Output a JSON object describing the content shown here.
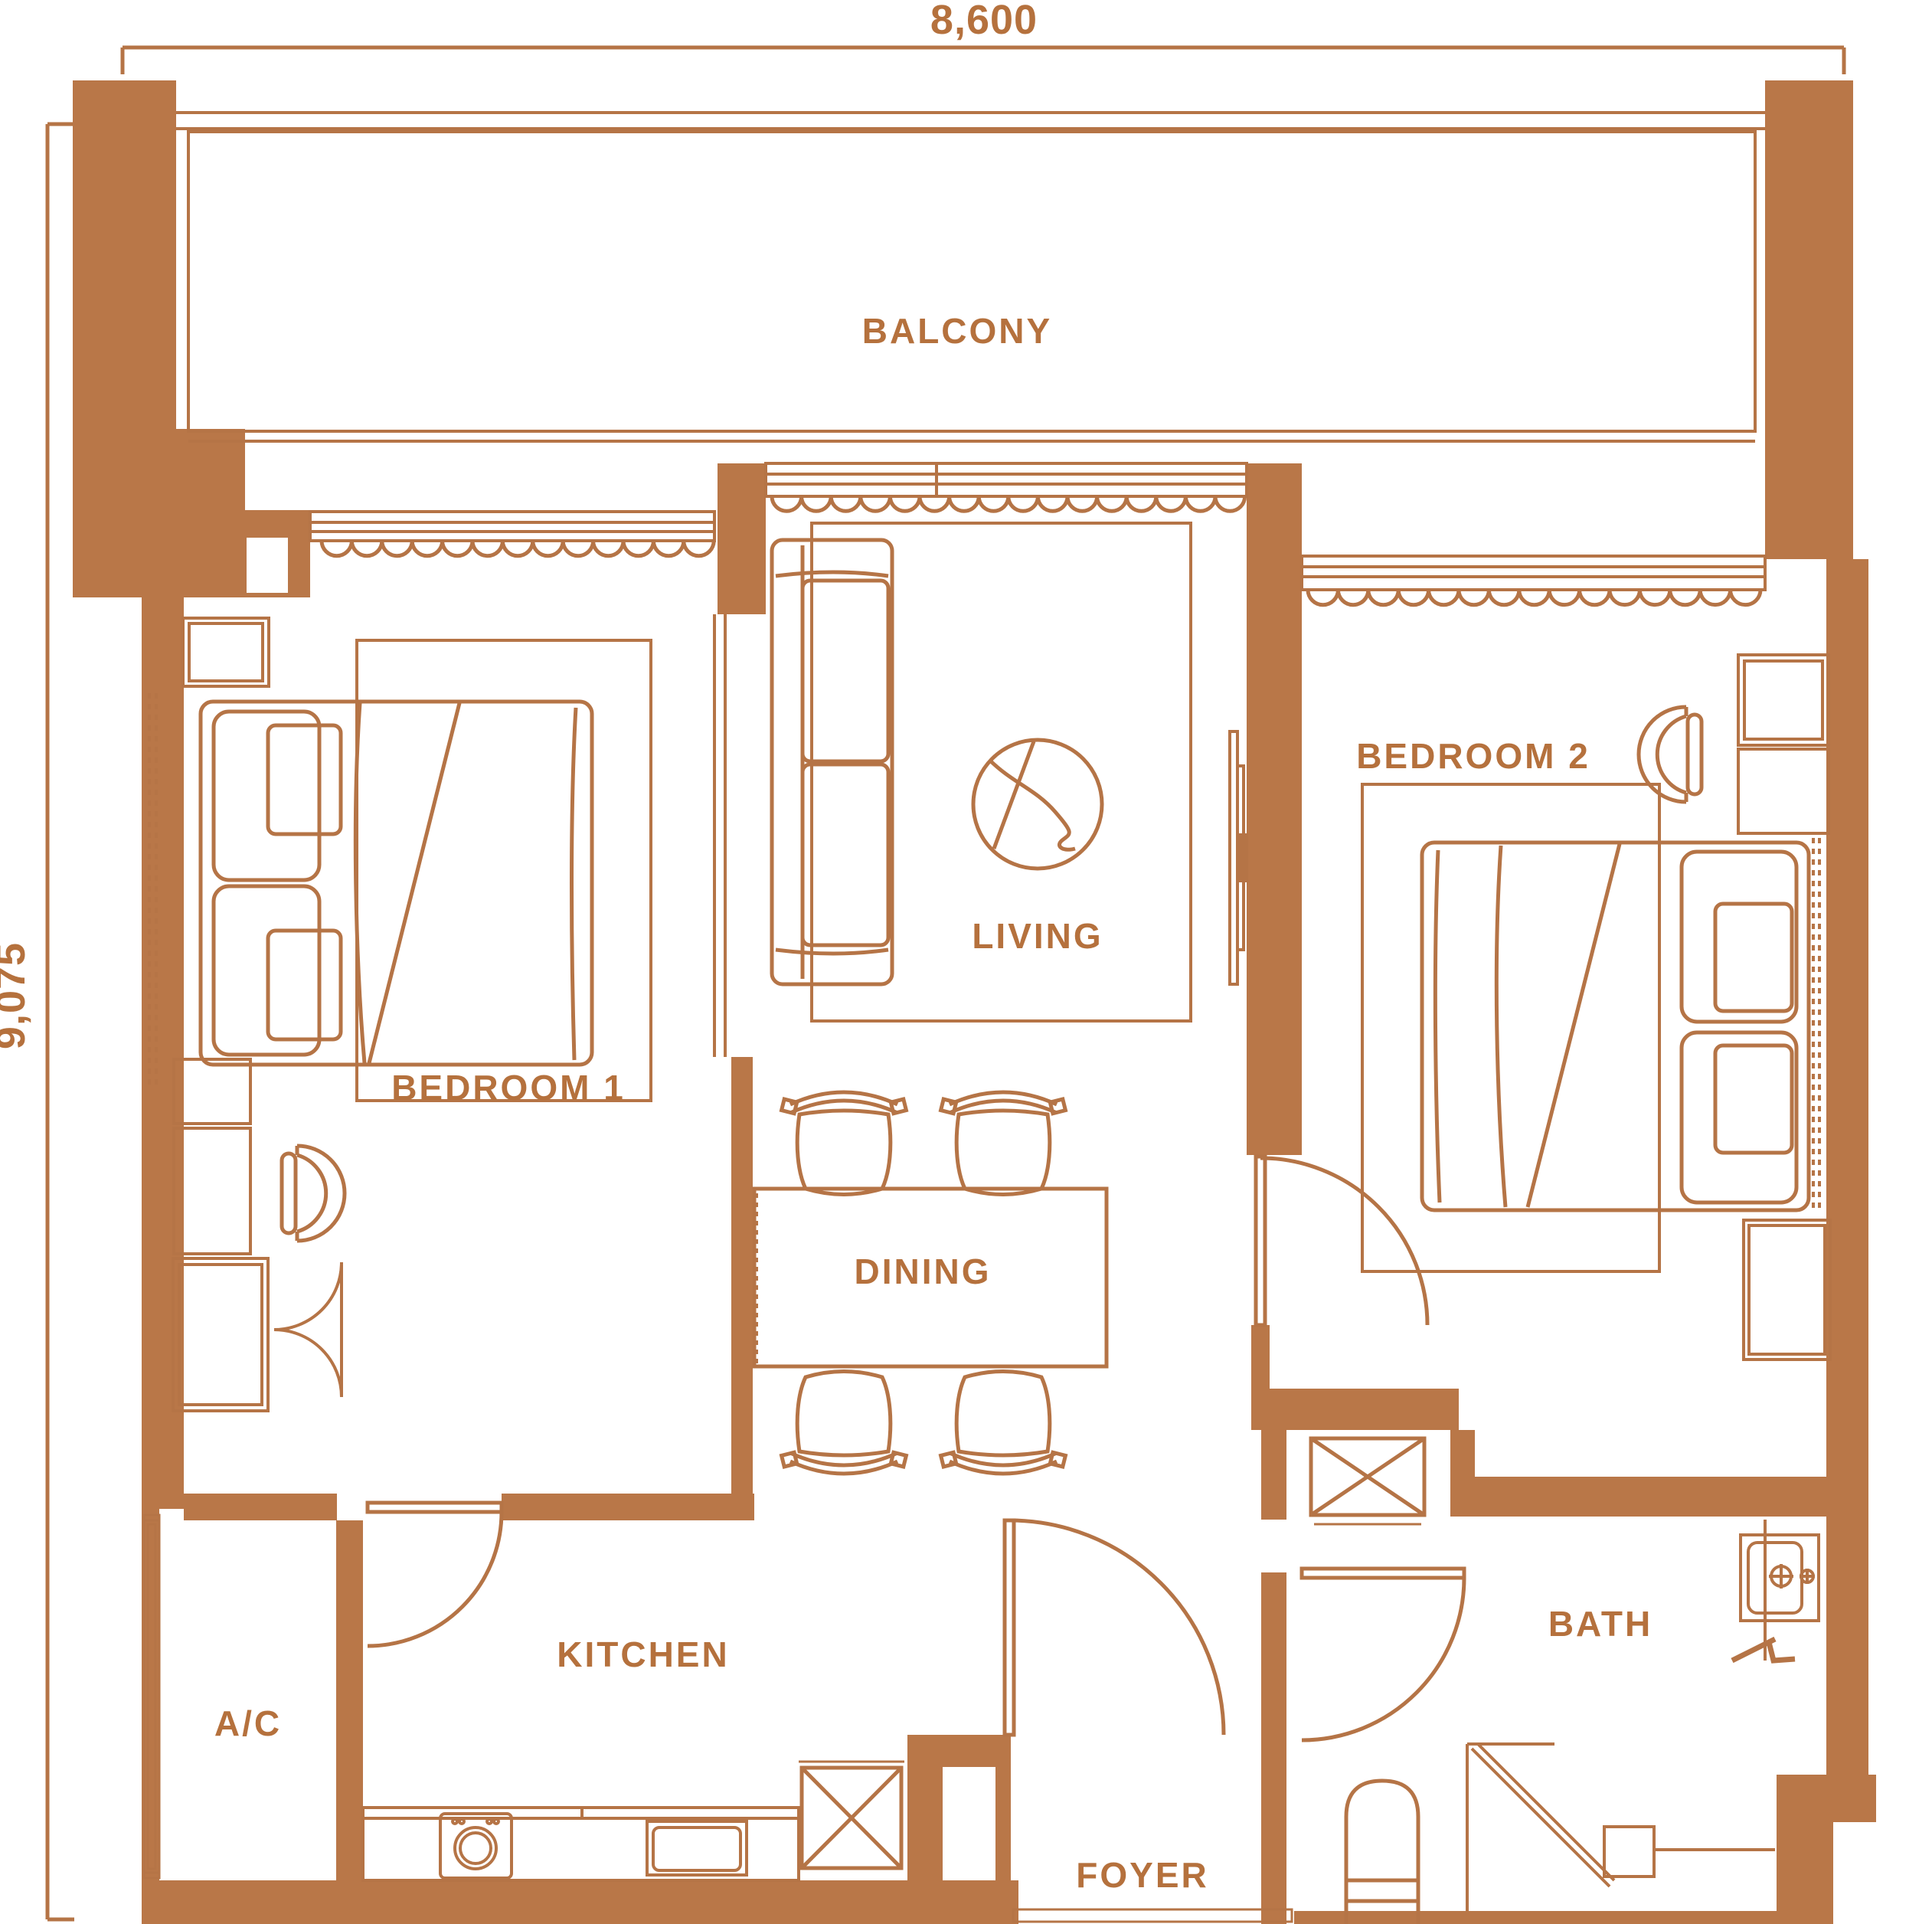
{
  "dimensions": {
    "width": "8,600",
    "height": "9,075"
  },
  "rooms": {
    "balcony": "BALCONY",
    "bedroom1": "BEDROOM 1",
    "living": "LIVING",
    "bedroom2": "BEDROOM 2",
    "dining": "DINING",
    "kitchen": "KITCHEN",
    "ac": "A/C",
    "foyer": "FOYER",
    "bath": "BATH"
  },
  "colors": {
    "wall_fill": "#B97748",
    "line": "#B57446",
    "label_text": "#B5713D",
    "background": "#FFFFFF"
  },
  "furniture_icons": [
    "double-bed-icon",
    "pillow-icon",
    "wardrobe-icon",
    "rug-icon",
    "sofa-icon",
    "tv-icon",
    "round-rug-icon",
    "dining-table-icon",
    "dining-chair-icon",
    "desk-chair-icon",
    "door-swing-icon",
    "sliding-window-icon",
    "curtain-icon",
    "washing-machine-icon",
    "kitchen-sink-icon",
    "shaft-x-icon",
    "bath-sink-icon",
    "toilet-icon",
    "shower-icon",
    "ac-louver-icon"
  ]
}
